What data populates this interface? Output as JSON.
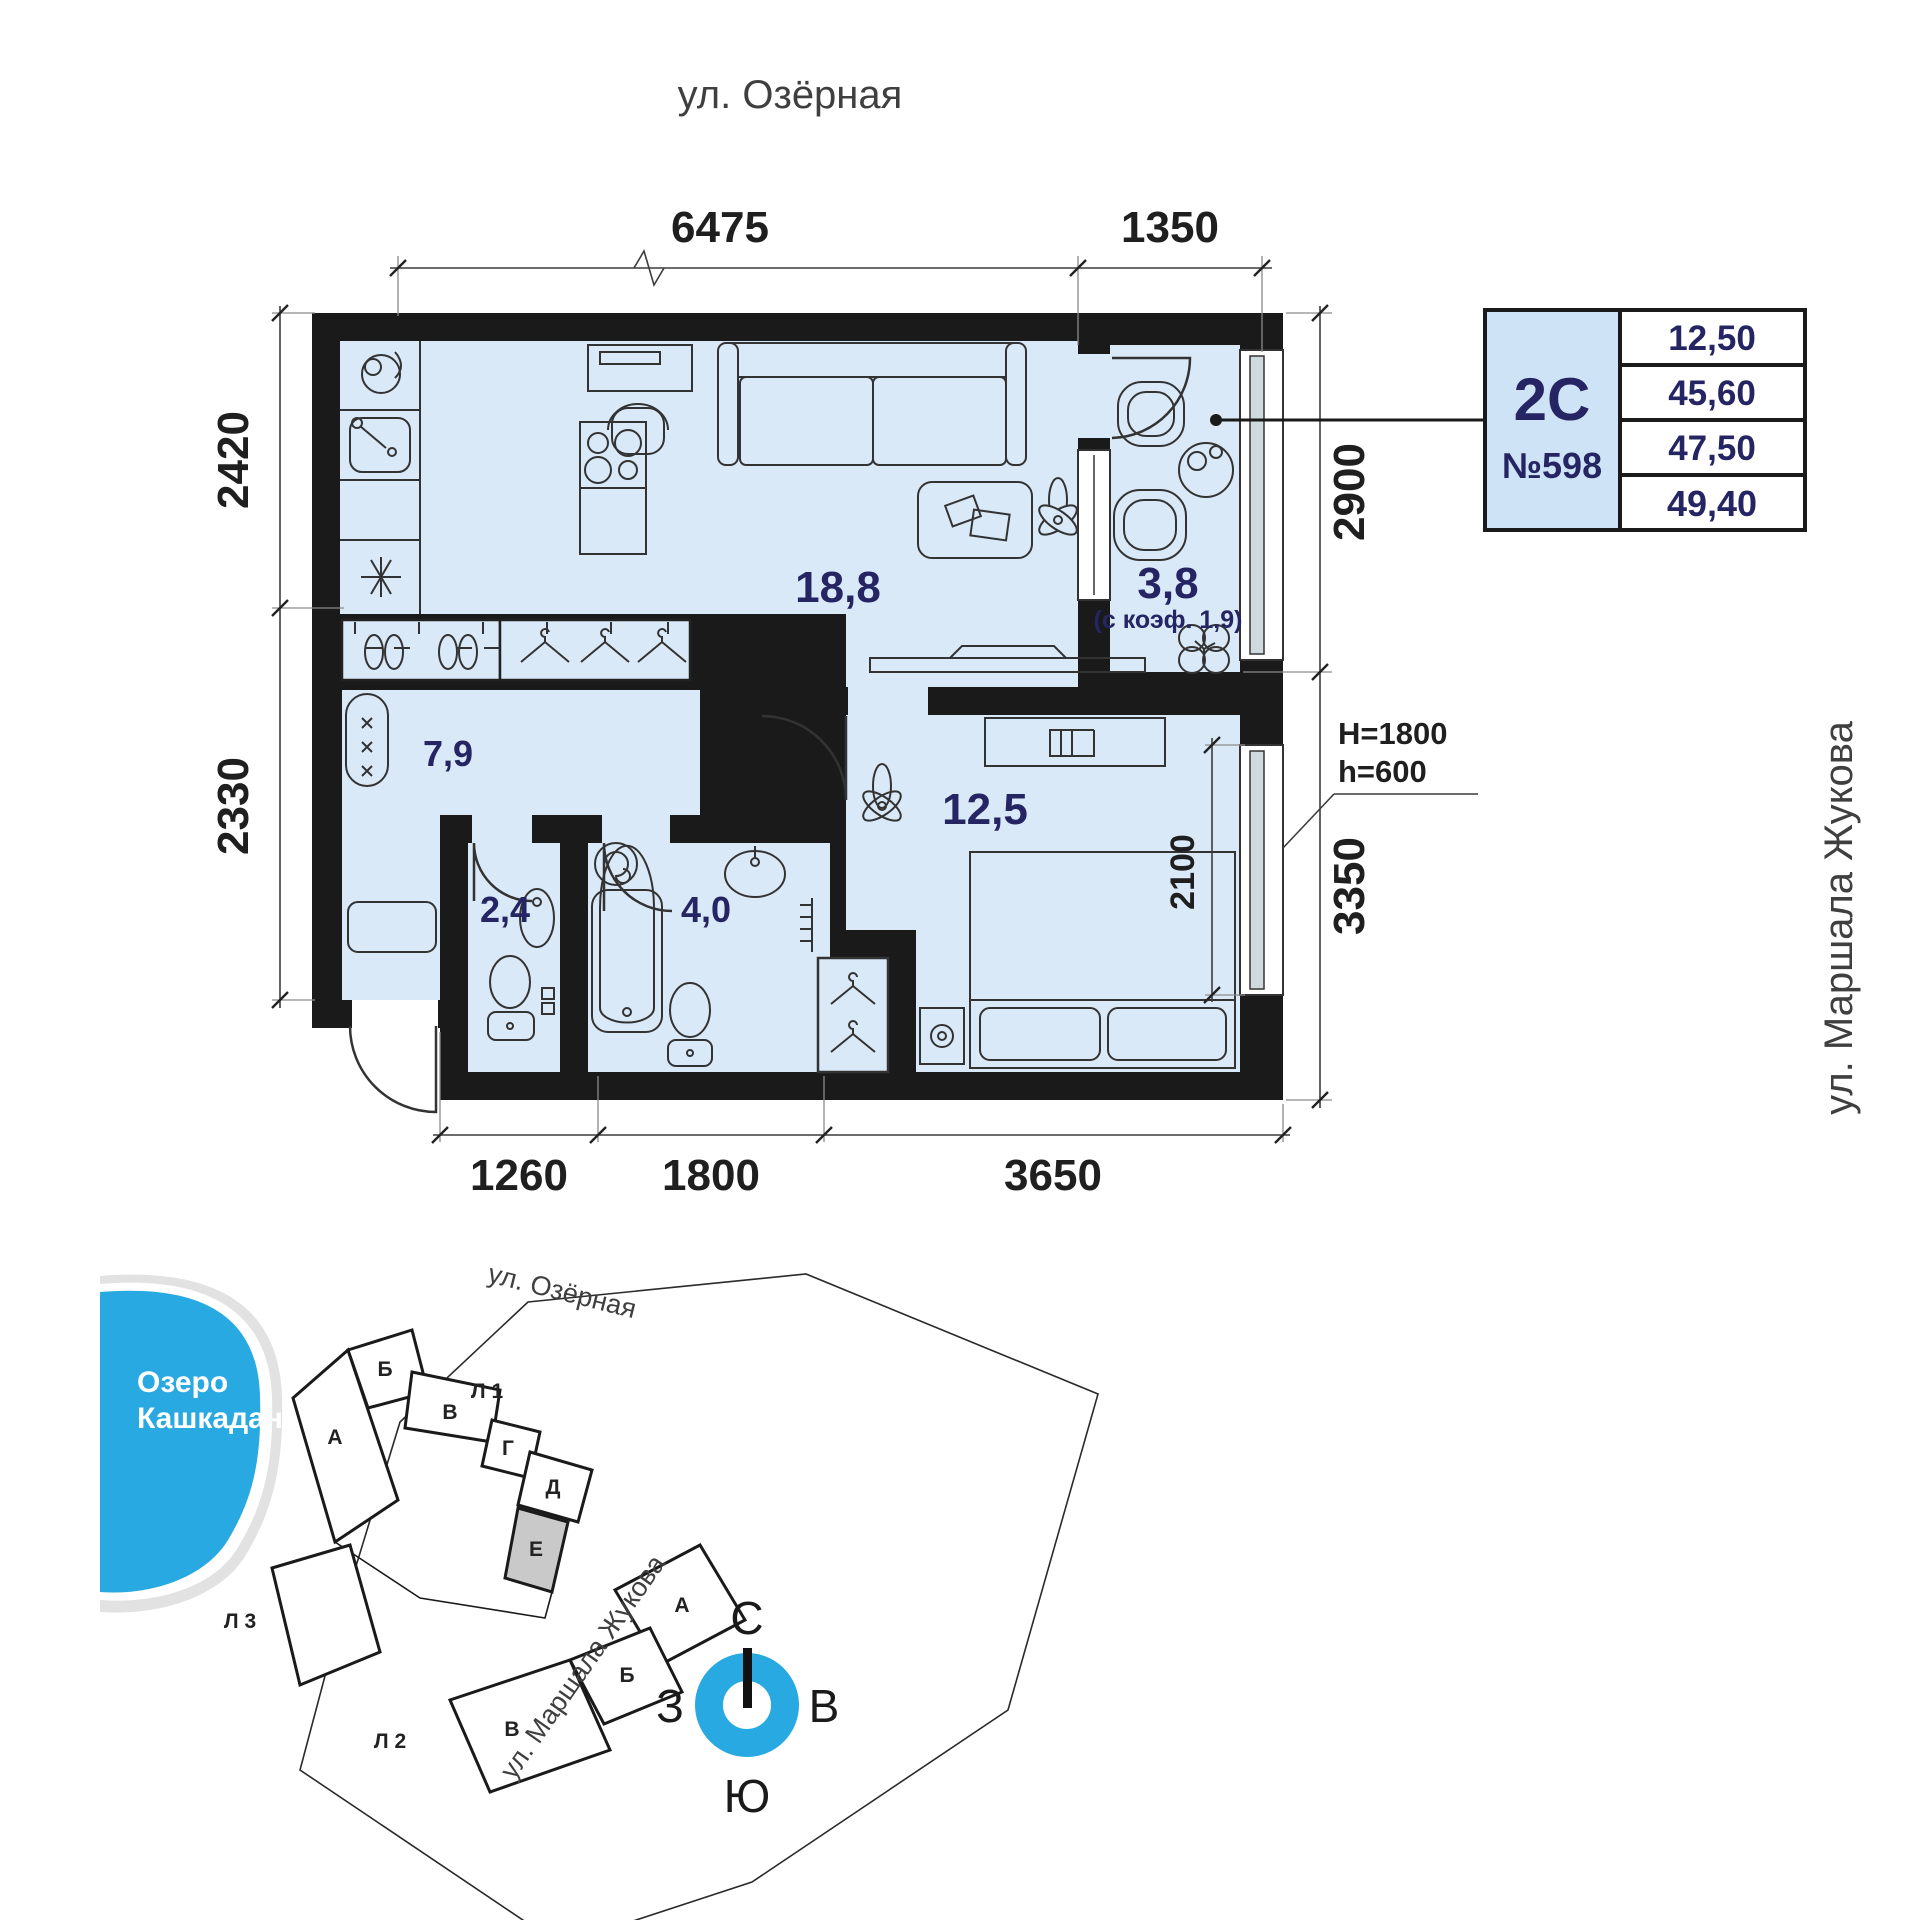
{
  "streets": {
    "top_label": "ул. Озёрная",
    "right_label": "ул. Маршала Жукова"
  },
  "plan": {
    "rooms": [
      {
        "name": "kitchen-living",
        "area": "18,8"
      },
      {
        "name": "balcony",
        "area": "3,8",
        "coef_note": "(с коэф. 1,9)"
      },
      {
        "name": "hallway",
        "area": "7,9"
      },
      {
        "name": "bedroom",
        "area": "12,5"
      },
      {
        "name": "wc",
        "area": "2,4"
      },
      {
        "name": "bathroom",
        "area": "4,0"
      }
    ],
    "dimensions": {
      "top": [
        "6475",
        "1350"
      ],
      "left": [
        "2420",
        "2330"
      ],
      "right": [
        "2900",
        "3350"
      ],
      "bottom": [
        "1260",
        "1800",
        "3650"
      ],
      "window": "2100"
    },
    "window_heights": [
      "Н=1800",
      "h=600"
    ]
  },
  "info_card": {
    "layout_type": "2С",
    "apartment_number": "№598",
    "areas": [
      "12,50",
      "45,60",
      "47,50",
      "49,40"
    ]
  },
  "site_plan": {
    "lake_label_line1": "Озеро",
    "lake_label_line2": "Кашкадан",
    "street_top": "ул. Озёрная",
    "street_right": "ул. Маршала Жукова",
    "sections": [
      "А",
      "Б",
      "В",
      "Г",
      "Д",
      "Е"
    ],
    "lower_sections": [
      "А",
      "Б",
      "В"
    ],
    "entrance_labels": [
      "Л 1",
      "Л 2",
      "Л 3"
    ],
    "highlighted_section": "Е"
  },
  "compass": {
    "north": "С",
    "south": "Ю",
    "west": "З",
    "east": "В"
  },
  "colors": {
    "room_fill": "#d9e9f8",
    "wall": "#1a1a1a",
    "accent_text": "#252563",
    "water": "#29a9e1",
    "highlighted_section_fill": "#c9c9c9",
    "glazing": "#cfdade"
  }
}
